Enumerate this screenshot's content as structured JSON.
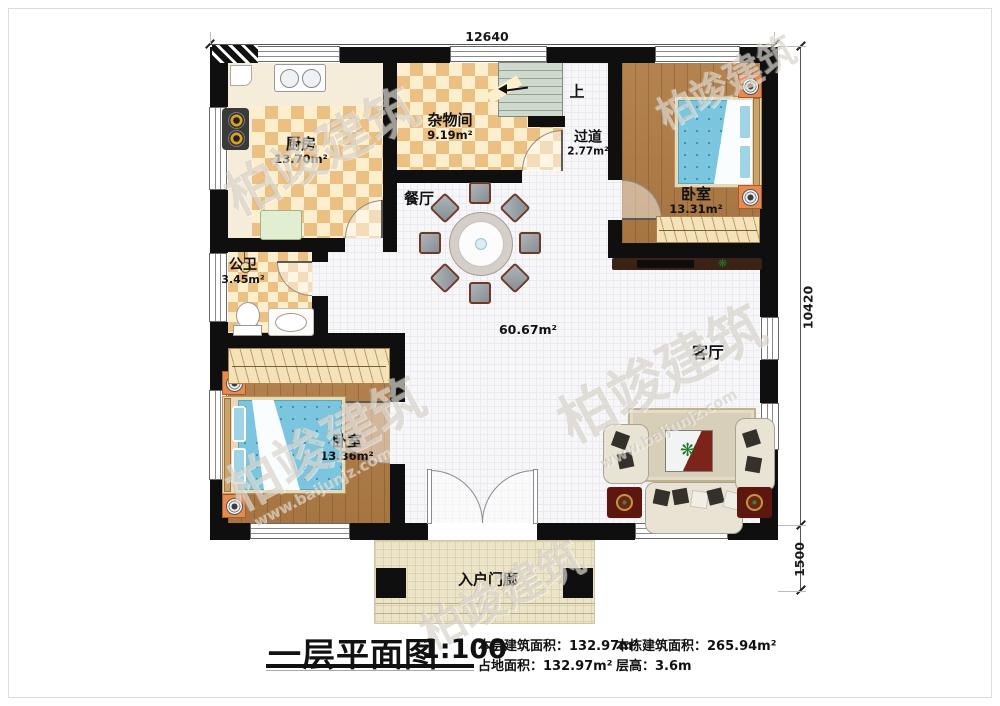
{
  "dimensions": {
    "width": "12640",
    "height": "10420",
    "porch_depth": "1500"
  },
  "rooms": {
    "kitchen": {
      "name": "厨房",
      "area": "13.70m²"
    },
    "storage": {
      "name": "杂物间",
      "area": "9.19m²"
    },
    "hallway": {
      "name": "过道",
      "area": "2.77m²"
    },
    "bedroom_top": {
      "name": "卧室",
      "area": "13.31m²"
    },
    "dining": {
      "name": "餐厅"
    },
    "bathroom": {
      "name": "公卫",
      "area": "3.45m²"
    },
    "bedroom_bottom": {
      "name": "卧室",
      "area": "13.36m²"
    },
    "living": {
      "name": "客厅"
    },
    "porch": {
      "name": "入户门廊"
    }
  },
  "annotations": {
    "up": "上",
    "open_area": "60.67m²"
  },
  "legend": {
    "title": "一层平面图",
    "scale": "1:100",
    "floor_area_label": "本层建筑面积：",
    "floor_area_value": "132.97m²",
    "total_area_label": "本栋建筑面积：",
    "total_area_value": "265.94m²",
    "land_area_label": "占地面积：",
    "land_area_value": "132.97m²",
    "height_label": "层高：",
    "height_value": "3.6m"
  },
  "watermark": {
    "brand": "柏竣建筑",
    "site": "www.baijunjz.com"
  },
  "colors": {
    "wall": "#0f0f0f",
    "checker_floor": "#ecbf82",
    "wood_floor": "#b07c45",
    "mattress": "#7cc5de",
    "stairs": "#cfd9cd",
    "porch": "#ece4c9",
    "accent_red": "#7a2117",
    "label_text": "#111111"
  }
}
